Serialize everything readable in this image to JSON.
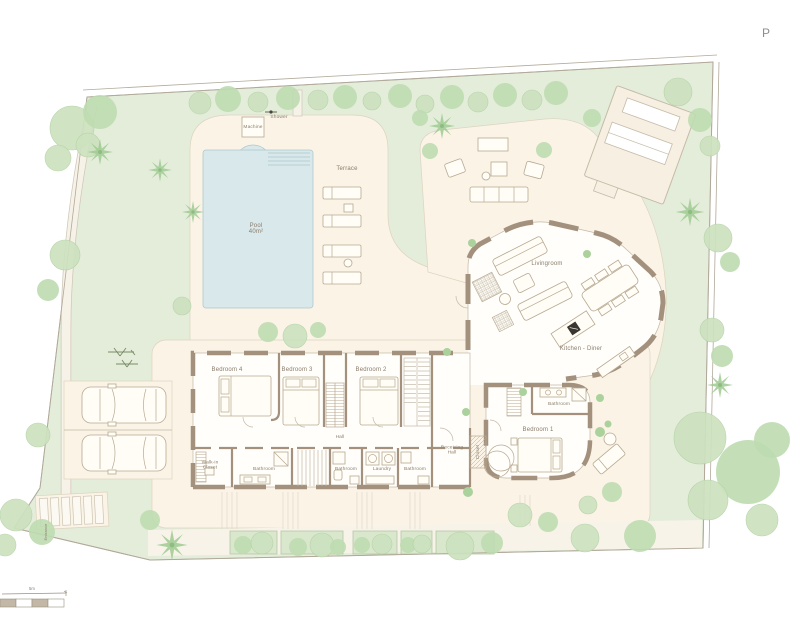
{
  "title": {
    "corner_text": "P"
  },
  "labels": {
    "pool_1": "Pool",
    "pool_2": "40m²",
    "machine": "Machine",
    "shower": "Shower",
    "terrace": "Terrace",
    "livingroom": "Livingroom",
    "kitchen_diner": "Kitchen - Diner",
    "bedroom4": "Bedroom 4",
    "bedroom3": "Bedroom 3",
    "bedroom2": "Bedroom 2",
    "bedroom1": "Bedroom 1",
    "hall": "Hall",
    "receiving_1": "Receiving",
    "receiving_2": "Hall",
    "walkin_1": "Walk-in",
    "walkin_2": "Closet",
    "bathroom_west": "Bathroom",
    "bathroom_mid": "Bathroom",
    "laundry": "Laundry",
    "bathroom_east": "Bathroom",
    "bathroom_master": "Bathroom",
    "closet_vertical": "Closet",
    "entrance_vertical": "Entrance",
    "scale": "5m"
  },
  "colors": {
    "site_green": "#e3edda",
    "tree": "#cde2bf",
    "tree_edge": "#b5d2a6",
    "tree2": "#bedcb0",
    "palm": "#9fca92",
    "dot": "#abd29c",
    "cream": "#faf3e6",
    "cream_edge": "#ddd3bf",
    "interior": "#fffefa",
    "wall": "#a3917d",
    "furn": "#b8a992",
    "line": "#c2baa9",
    "pool": "#d8e8eb",
    "pool_edge": "#aec9cf",
    "label": "#8a7d6d",
    "boundary": "#b1a99a",
    "path_fill": "#f7f3e9"
  }
}
